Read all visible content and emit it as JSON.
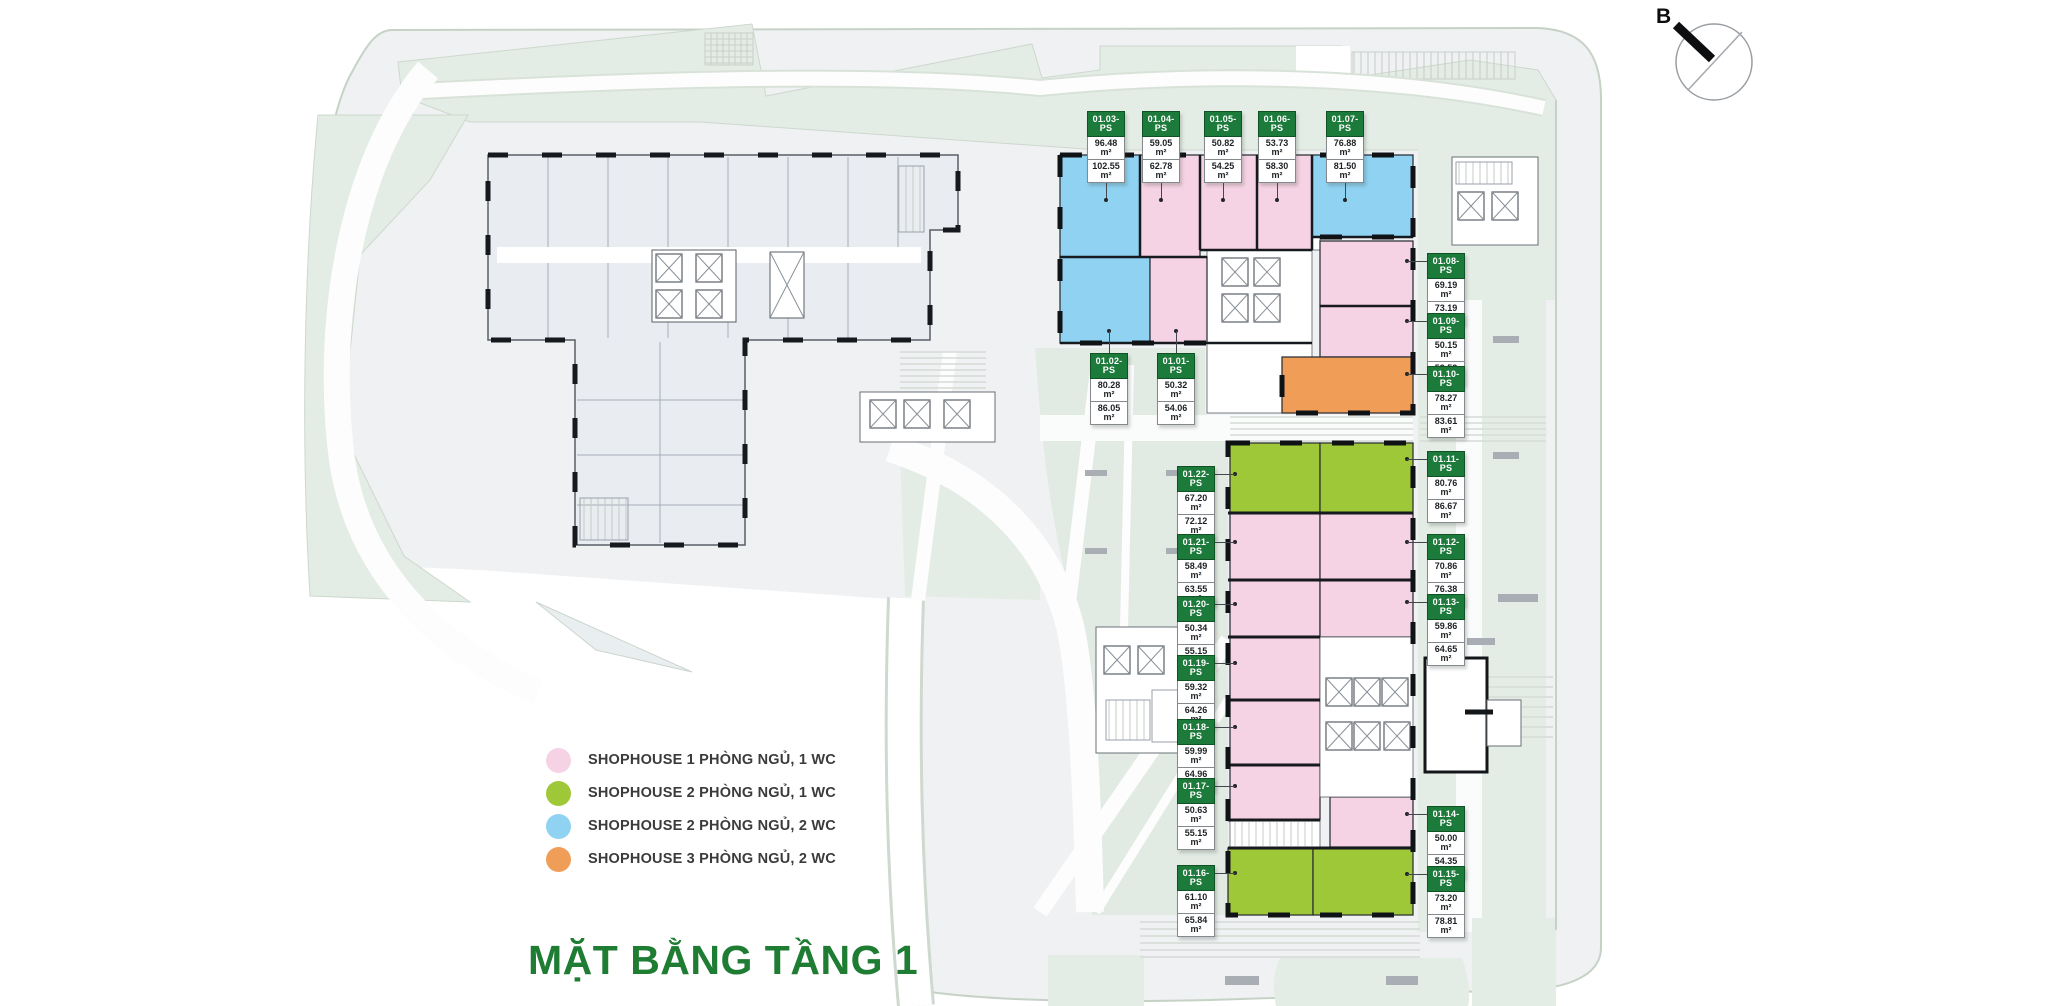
{
  "page": {
    "title": "MẶT BẰNG TẦNG 1",
    "compass_label": "B"
  },
  "palette": {
    "unit_pink": "#f6d3e4",
    "unit_green": "#9fc838",
    "unit_blue": "#8fd2f2",
    "unit_orange": "#f09d58",
    "label_green": "#1c7a3a",
    "title_green": "#1e7c33"
  },
  "legend": {
    "items": [
      {
        "label": "SHOPHOUSE 1 PHÒNG NGỦ, 1 WC",
        "color": "#f6d3e4"
      },
      {
        "label": "SHOPHOUSE 2 PHÒNG NGỦ, 1 WC",
        "color": "#9fc838"
      },
      {
        "label": "SHOPHOUSE 2 PHÒNG NGỦ, 2 WC",
        "color": "#8fd2f2"
      },
      {
        "label": "SHOPHOUSE 3 PHÒNG NGỦ, 2 WC",
        "color": "#f09d58"
      }
    ]
  },
  "units": [
    {
      "id": "01.01-PS",
      "area1": "50.32 m²",
      "area2": "54.06 m²",
      "color": "#f6d3e4"
    },
    {
      "id": "01.02-PS",
      "area1": "80.28 m²",
      "area2": "86.05 m²",
      "color": "#8fd2f2"
    },
    {
      "id": "01.03-PS",
      "area1": "96.48 m²",
      "area2": "102.55 m²",
      "color": "#8fd2f2"
    },
    {
      "id": "01.04-PS",
      "area1": "59.05 m²",
      "area2": "62.78 m²",
      "color": "#f6d3e4"
    },
    {
      "id": "01.05-PS",
      "area1": "50.82 m²",
      "area2": "54.25 m²",
      "color": "#f6d3e4"
    },
    {
      "id": "01.06-PS",
      "area1": "53.73 m²",
      "area2": "58.30 m²",
      "color": "#f6d3e4"
    },
    {
      "id": "01.07-PS",
      "area1": "76.88 m²",
      "area2": "81.50 m²",
      "color": "#8fd2f2"
    },
    {
      "id": "01.08-PS",
      "area1": "69.19 m²",
      "area2": "73.19 m²",
      "color": "#f6d3e4"
    },
    {
      "id": "01.09-PS",
      "area1": "50.15 m²",
      "area2": "53.53 m²",
      "color": "#f6d3e4"
    },
    {
      "id": "01.10-PS",
      "area1": "78.27 m²",
      "area2": "83.61 m²",
      "color": "#f09d58"
    },
    {
      "id": "01.11-PS",
      "area1": "80.76 m²",
      "area2": "86.67 m²",
      "color": "#9fc838"
    },
    {
      "id": "01.12-PS",
      "area1": "70.86 m²",
      "area2": "76.38 m²",
      "color": "#f6d3e4"
    },
    {
      "id": "01.13-PS",
      "area1": "59.86 m²",
      "area2": "64.65 m²",
      "color": "#f6d3e4"
    },
    {
      "id": "01.14-PS",
      "area1": "50.00 m²",
      "area2": "54.35 m²",
      "color": "#f6d3e4"
    },
    {
      "id": "01.15-PS",
      "area1": "73.20 m²",
      "area2": "78.81 m²",
      "color": "#9fc838"
    },
    {
      "id": "01.16-PS",
      "area1": "61.10 m²",
      "area2": "65.84 m²",
      "color": "#9fc838"
    },
    {
      "id": "01.17-PS",
      "area1": "50.63 m²",
      "area2": "55.15 m²",
      "color": "#f6d3e4"
    },
    {
      "id": "01.18-PS",
      "area1": "59.99 m²",
      "area2": "64.96 m²",
      "color": "#f6d3e4"
    },
    {
      "id": "01.19-PS",
      "area1": "59.32 m²",
      "area2": "64.26 m²",
      "color": "#f6d3e4"
    },
    {
      "id": "01.20-PS",
      "area1": "50.34 m²",
      "area2": "55.15 m²",
      "color": "#f6d3e4"
    },
    {
      "id": "01.21-PS",
      "area1": "58.49 m²",
      "area2": "63.55 m²",
      "color": "#f6d3e4"
    },
    {
      "id": "01.22-PS",
      "area1": "67.20 m²",
      "area2": "72.12 m²",
      "color": "#9fc838"
    }
  ]
}
